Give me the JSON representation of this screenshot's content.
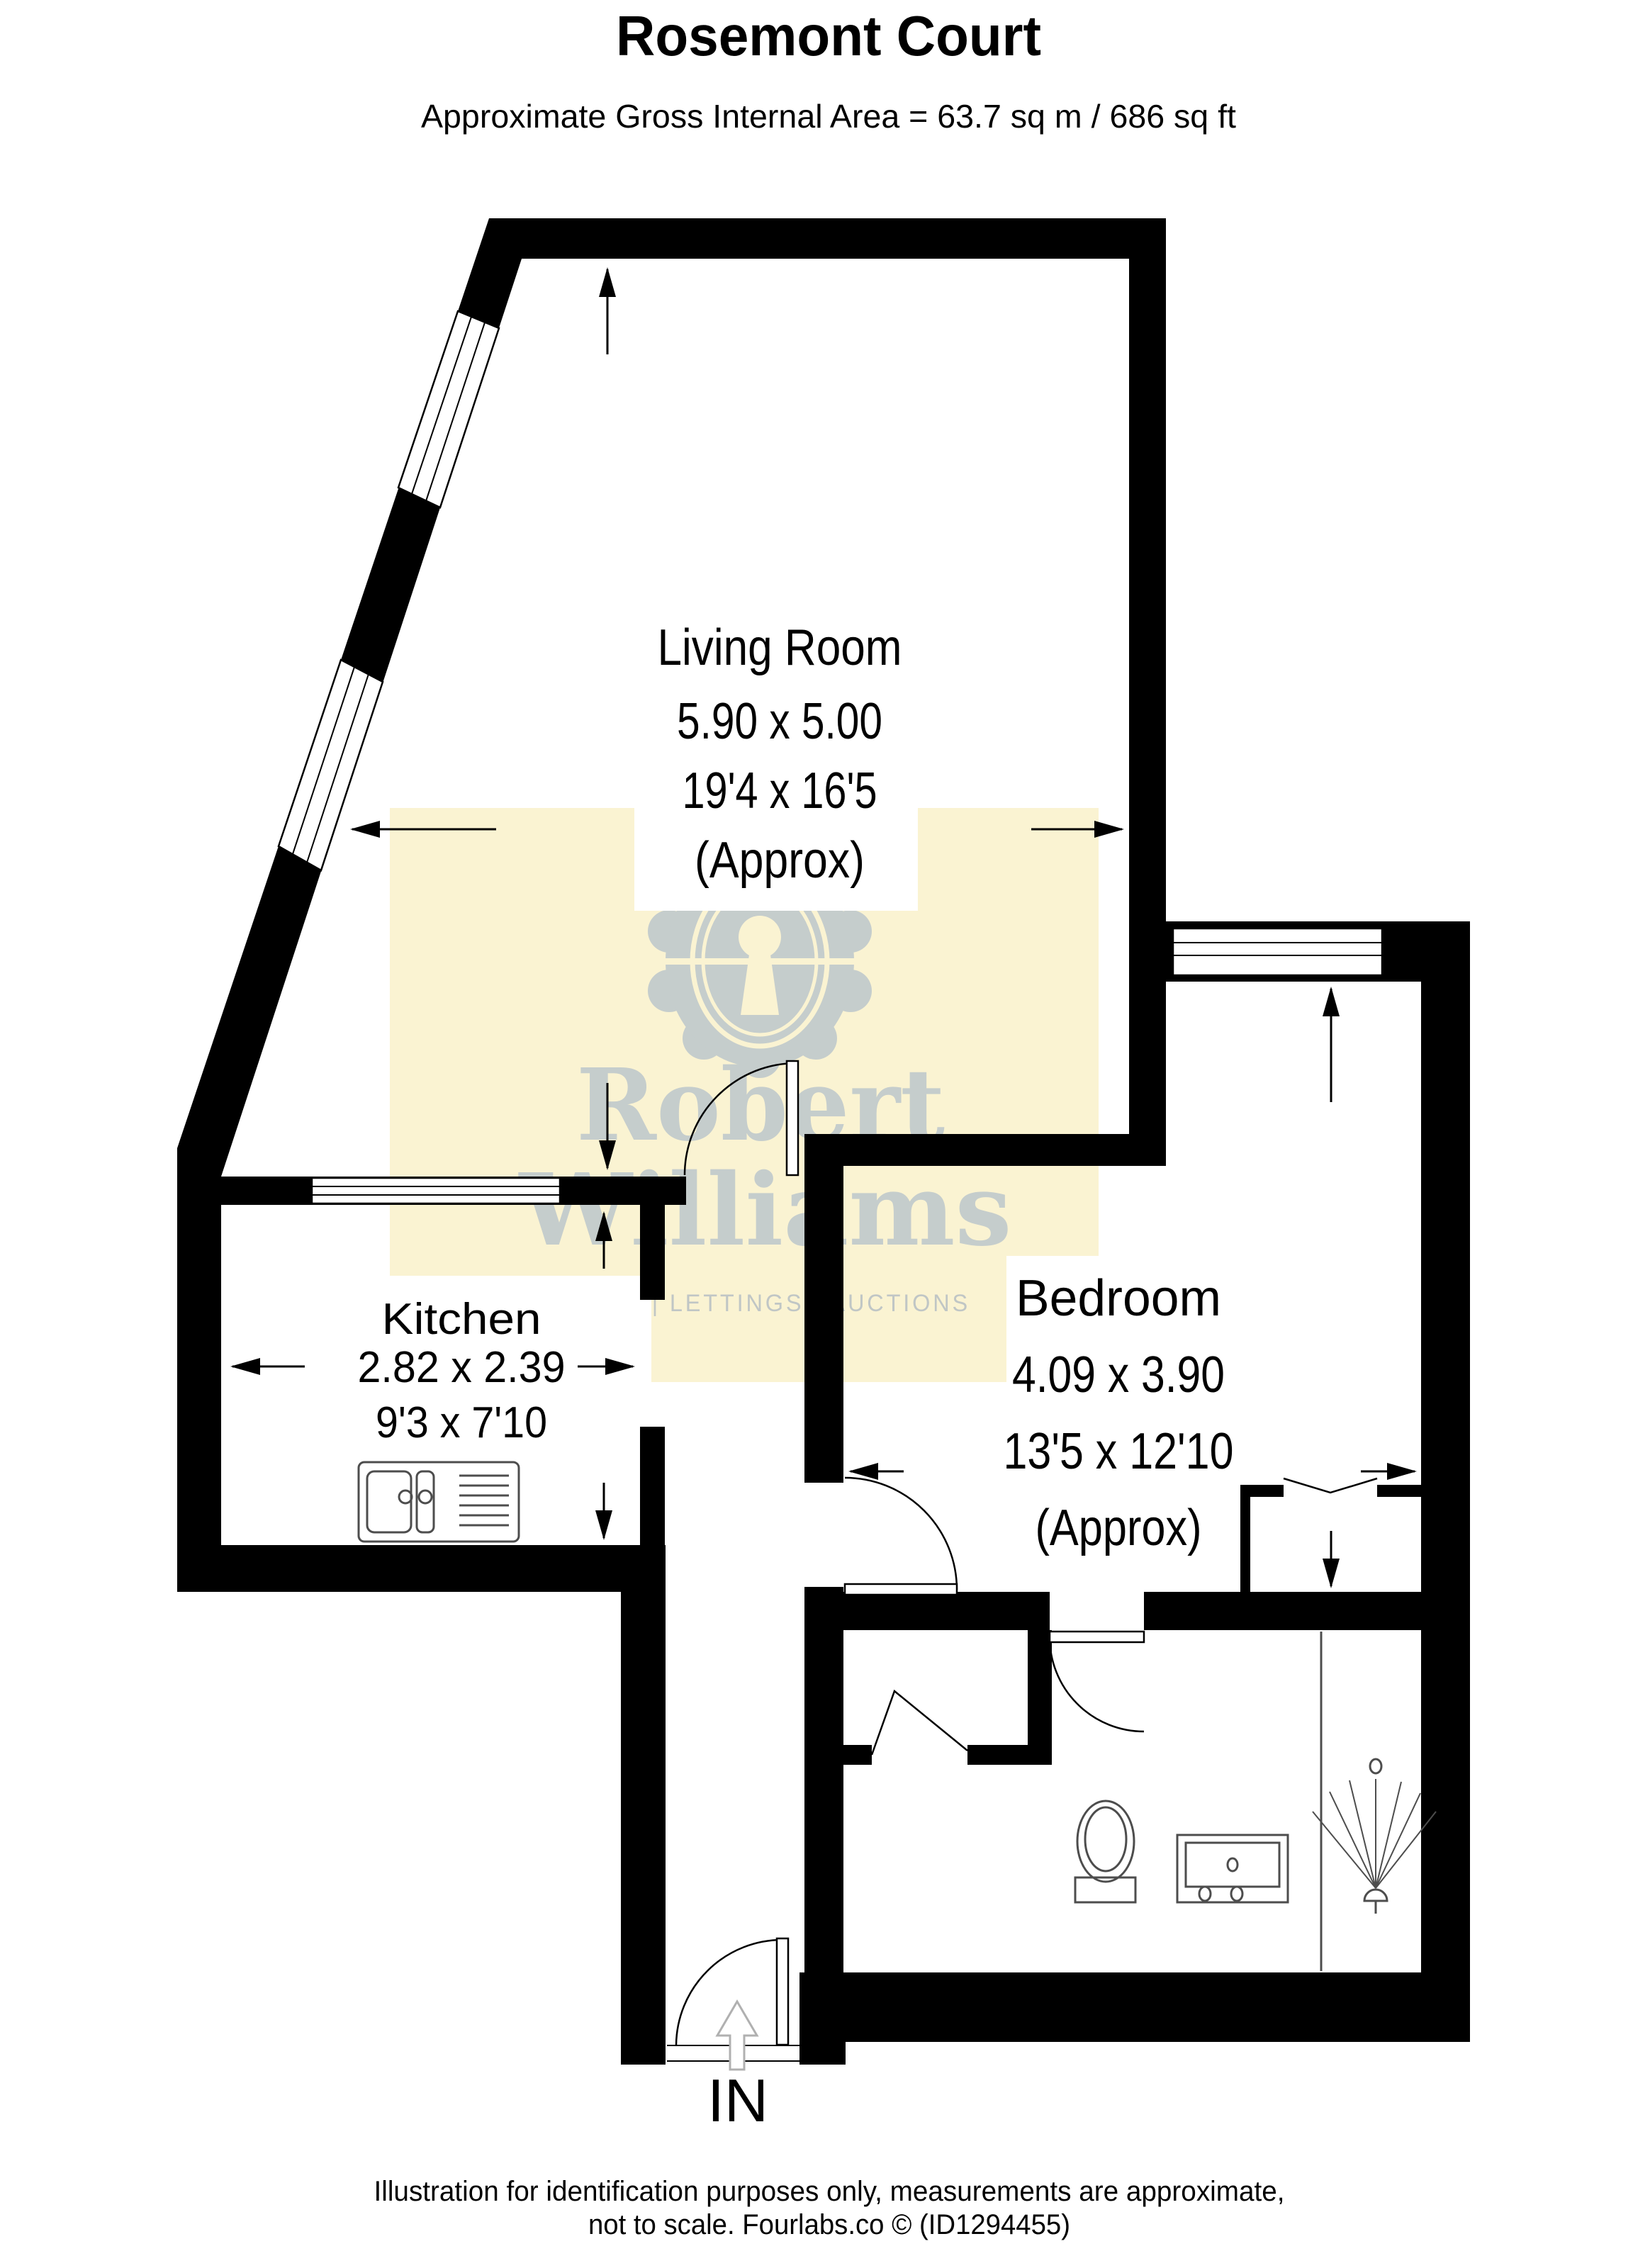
{
  "header": {
    "title": "Rosemont Court",
    "subtitle": "Approximate Gross Internal Area = 63.7 sq m / 686 sq ft"
  },
  "rooms": {
    "living_room": {
      "name": "Living Room",
      "metric": "5.90 x 5.00",
      "imperial": "19'4 x 16'5",
      "approx": "(Approx)"
    },
    "kitchen": {
      "name": "Kitchen",
      "metric": "2.82 x 2.39",
      "imperial": "9'3 x 7'10"
    },
    "bedroom": {
      "name": "Bedroom",
      "metric": "4.09 x 3.90",
      "imperial": "13'5 x 12'10",
      "approx": "(Approx)"
    }
  },
  "entrance": {
    "label": "IN"
  },
  "watermark": {
    "line1": "Robert",
    "line2": "Williams",
    "tagline": "SALES | LETTINGS | AUCTIONS"
  },
  "footer": {
    "line1": "Illustration for identification purposes only, measurements are approximate,",
    "line2": "not to scale. Fourlabs.co © (ID1294455)"
  },
  "colors": {
    "wall": "#000000",
    "watermark_bg": "#faf3d2",
    "watermark_fg": "#c5cdcc",
    "fixture_stroke": "#4d4d4d",
    "entry_arrow": "#b0b0b0",
    "background": "#ffffff"
  }
}
